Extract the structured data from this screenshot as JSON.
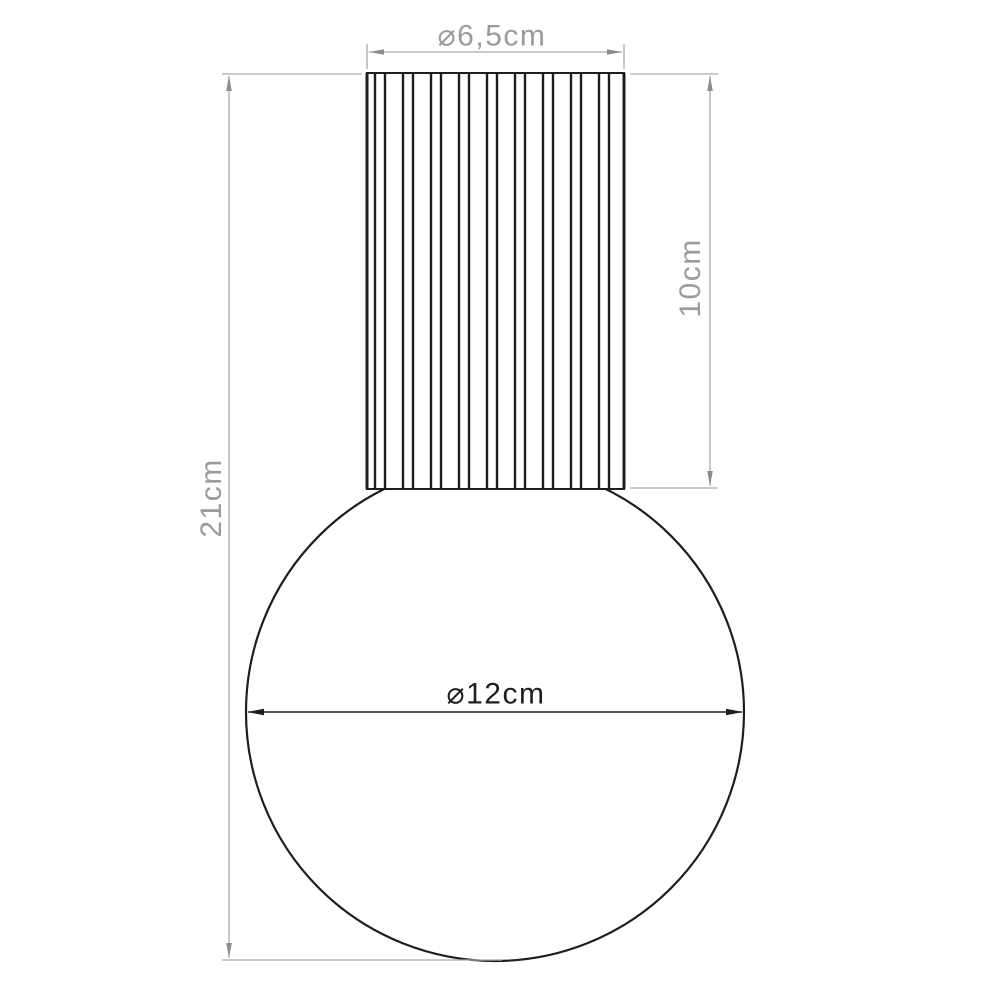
{
  "diagram": {
    "title": "Lamp technical dimension drawing",
    "object": "pendant lamp with fluted cylindrical socket cover above a spherical glass globe",
    "background_color": "#ffffff",
    "colors": {
      "object_outline": "#1e1e1e",
      "dimension_line_gray": "#ababab",
      "dimension_arrow_gray": "#8c8c8c",
      "dimension_text_gray": "#9b9b9b",
      "dimension_dark": "#1e1e1e"
    },
    "dimensions": {
      "cylinder_diameter": {
        "label": "⌀5 6,5cm",
        "text": "⌀6,5cm",
        "value_cm": 6.5,
        "orientation": "horizontal",
        "position": "top"
      },
      "cylinder_height": {
        "text": "10cm",
        "value_cm": 10,
        "orientation": "vertical",
        "position": "right"
      },
      "total_height": {
        "text": "21cm",
        "value_cm": 21,
        "orientation": "vertical",
        "position": "left"
      },
      "sphere_diameter": {
        "text": "⌀12cm",
        "value_cm": 12,
        "orientation": "horizontal",
        "position": "middle"
      }
    }
  }
}
